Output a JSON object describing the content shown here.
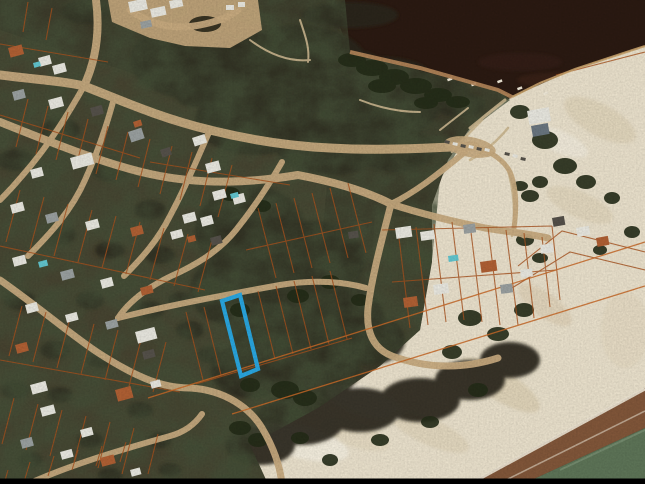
{
  "image": {
    "kind": "aerial-satellite-photo",
    "subject": "coastal beach town seen from above with cadastral parcel overlay lines and one vacant lot outlined in blue",
    "width_px": 645,
    "height_px": 484
  },
  "colors": {
    "lagoon_water": "#2b1a12",
    "sea_water": "#5e7558",
    "wet_sand": "#82573a",
    "beach_sand": "#ebe2cd",
    "dune_shadow": "#d9cbae",
    "scrub_ground": "#3a3426",
    "town_ground": "#4a4231",
    "block_ground": "#45402f",
    "vegetation": "#242c18",
    "veg_mass": "#2a281a",
    "road_sand": "#c8ab80",
    "path_sand": "#cdb891",
    "parcel_line": "#a8521e",
    "parcel_line_bright": "#c96a28",
    "highlight_blue": "#2aa7e0",
    "house_white": "#e9e8e0",
    "house_gray": "#9aa0a0",
    "house_terracotta": "#b06034",
    "house_dark": "#55514a",
    "roof_slate": "#6a7680",
    "pool_teal": "#62c6cf",
    "foam": "#f1ead9",
    "shore_mud": "#b98a5c",
    "shore_line_orange": "#caa36c",
    "letterbox": "#000000"
  },
  "highlight_parcel": {
    "outline_color": "#2aa7e0",
    "shape": "narrow rectangular lot",
    "corners_px": [
      [
        222,
        301
      ],
      [
        240,
        295
      ],
      [
        258,
        369
      ],
      [
        241,
        376
      ]
    ],
    "location": "mid-block between the town grid and the beach dunes, fronting a sand street"
  },
  "features": {
    "water_top_right": "dark lagoon / river mouth water",
    "beach_right": "white sand beach and dune field",
    "sea_bottom_right": "green ocean with surf foam line",
    "town_left": "residential grid of sand roads, small houses and trees",
    "parcel_overlay": "thin orange cadastral lot lines across town, scrub and dunes",
    "boats_count": 5,
    "letterbox_bar_bottom": true
  }
}
